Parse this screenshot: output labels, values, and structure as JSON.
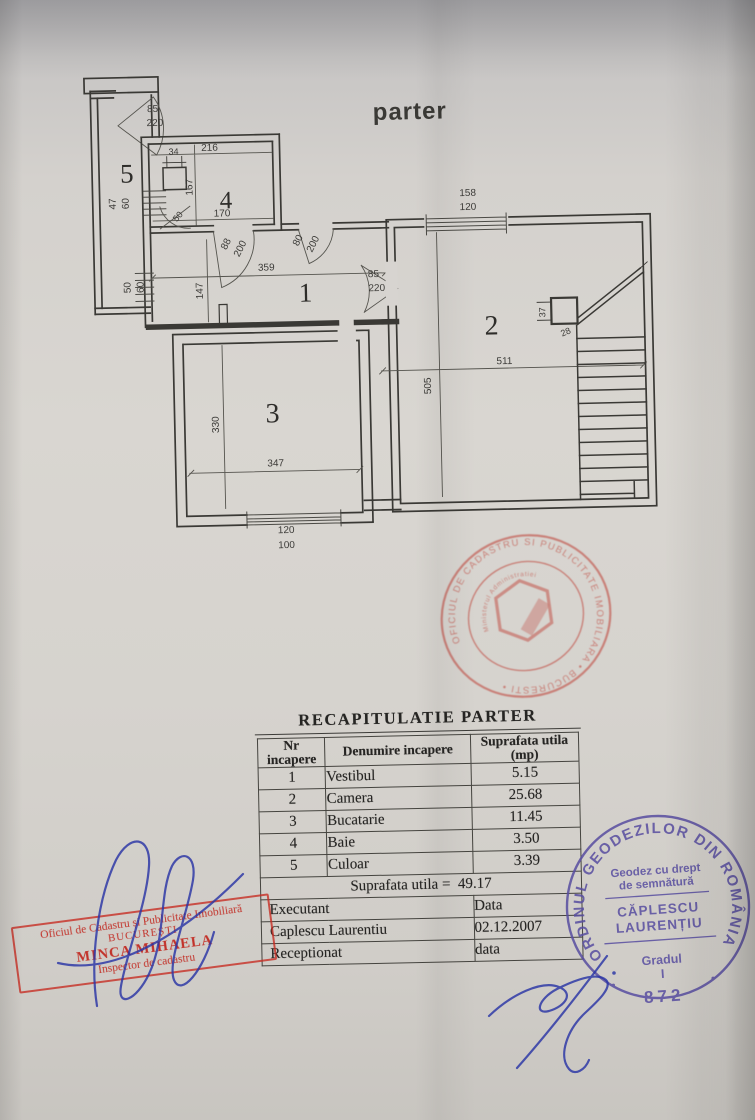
{
  "document": {
    "floor_title": "parter"
  },
  "plan": {
    "room_numbers": {
      "r1": "1",
      "r2": "2",
      "r3": "3",
      "r4": "4",
      "r5": "5"
    },
    "dims": {
      "entry_door_w": "85",
      "entry_door_h": "220",
      "d216": "216",
      "d34": "34",
      "d167": "167",
      "d170": "170",
      "d47": "47",
      "d60a": "60",
      "d50a": "50",
      "d88": "88",
      "d200a": "200",
      "d80": "80",
      "d200b": "200",
      "d359": "359",
      "d147": "147",
      "d50b": "50",
      "d60b": "60",
      "hall_door_w": "85",
      "hall_door_h": "220",
      "win2_w": "158",
      "win2_h": "120",
      "d511": "511",
      "d505": "505",
      "d37": "37",
      "d28": "28",
      "d330": "330",
      "d347": "347",
      "win3_w": "120",
      "win3_h": "100"
    }
  },
  "summary_table": {
    "title": "RECAPITULATIE  PARTER",
    "col_nr": "Nr\nincapere",
    "col_name": "Denumire incapere",
    "col_area": "Suprafata utila\n(mp)",
    "rows": [
      {
        "nr": "1",
        "name": "Vestibul",
        "area": "5.15"
      },
      {
        "nr": "2",
        "name": "Camera",
        "area": "25.68"
      },
      {
        "nr": "3",
        "name": "Bucatarie",
        "area": "11.45"
      },
      {
        "nr": "4",
        "name": "Baie",
        "area": "3.50"
      },
      {
        "nr": "5",
        "name": "Culoar",
        "area": "3.39"
      }
    ],
    "total_label": "Suprafata utila =",
    "total_value": "49.17",
    "executant_label": "Executant",
    "executant_name": "Caplescu Laurentiu",
    "data_label": "Data",
    "data_value": "02.12.2007",
    "receptionat_label": "Receptionat",
    "receptionat_value": "data"
  },
  "stamps": {
    "office_round": {
      "ring_text": "OFICIUL DE CADASTRU SI PUBLICITATE IMOBILIARA • BUCURESTI •",
      "inner_text": "Ministerul Administratiei"
    },
    "geodez_round": {
      "ring_text": "ORDINUL GEODEZILOR DIN ROMÂNIA",
      "line1": "Geodez cu drept",
      "line2": "de semnătură",
      "name_line1": "CĂPLESCU",
      "name_line2": "LAURENȚIU",
      "grade_label": "Gradul",
      "grade_value": "I",
      "number": "872"
    },
    "office_rect": {
      "line1": "Oficiul de Cadastru și Publicitate Imobiliară",
      "line2": "BUCUREȘTI",
      "line3": "MINCA MIHAELA",
      "line4": "Inspector de cadastru"
    }
  }
}
